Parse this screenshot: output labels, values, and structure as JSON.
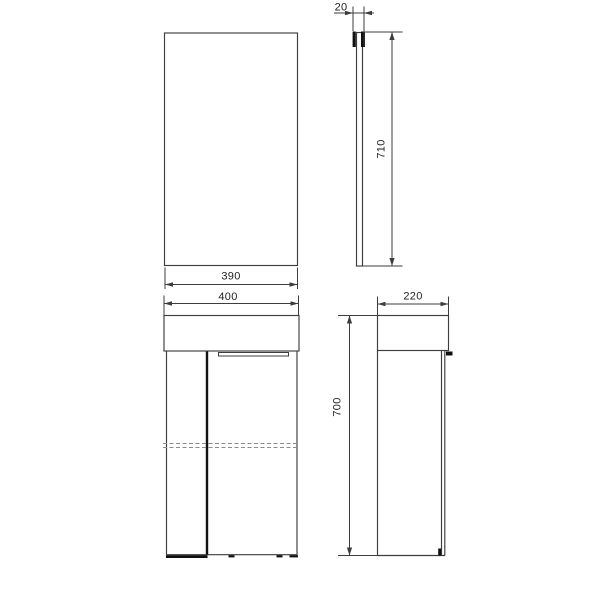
{
  "colors": {
    "background": "#ffffff",
    "line": "#3d3d3d",
    "dark": "#111111",
    "dashed": "#8c8c8c",
    "text": "#1f1f1f"
  },
  "views": {
    "mirror_front": {
      "width_label": "390"
    },
    "mirror_side": {
      "thickness_label": "20",
      "height_label": "710"
    },
    "cabinet_front": {
      "width_label": "400"
    },
    "cabinet_side": {
      "depth_label": "220",
      "height_label": "700"
    }
  }
}
